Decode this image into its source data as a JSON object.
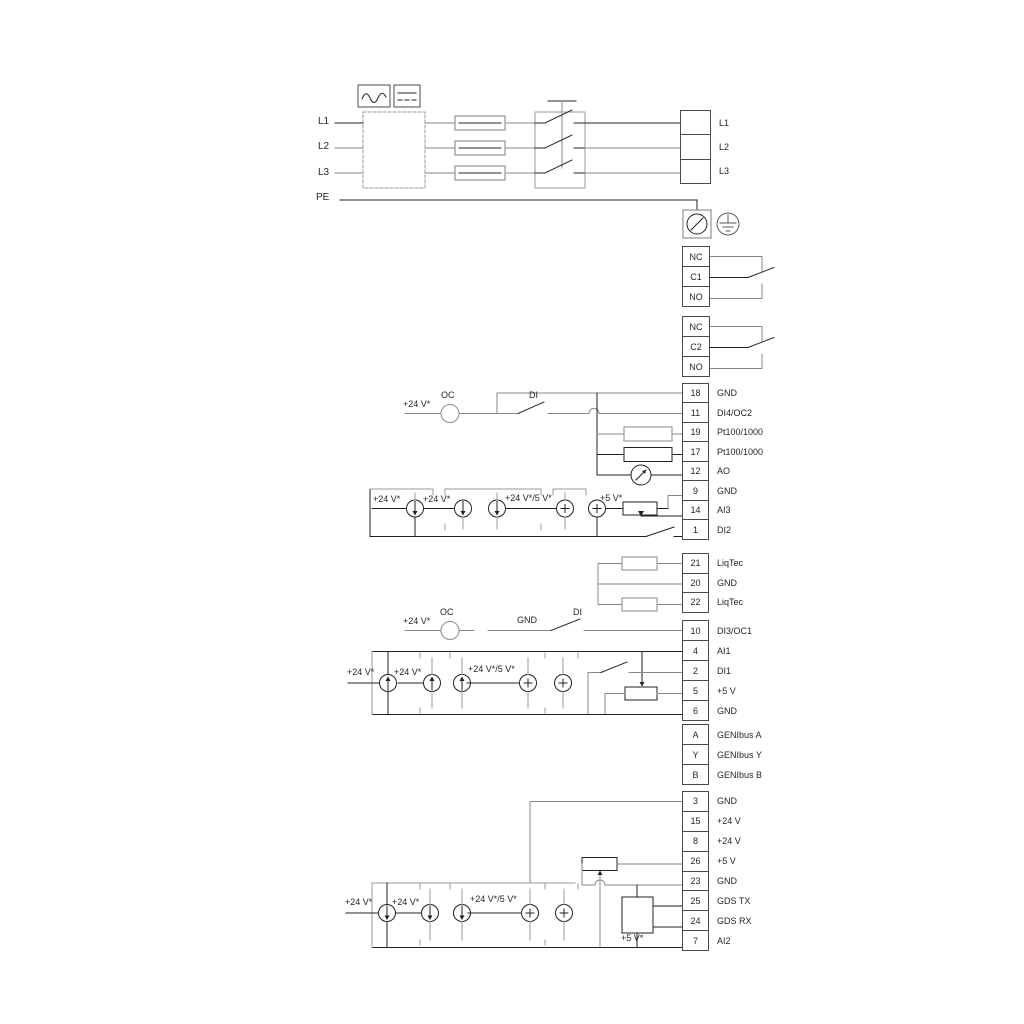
{
  "diagram": {
    "title": "drive terminal wiring diagram",
    "inputs": [
      "L1",
      "L2",
      "L3",
      "PE"
    ],
    "strips": {
      "power": [
        {
          "num": "",
          "label": "L1"
        },
        {
          "num": "",
          "label": "L2"
        },
        {
          "num": "",
          "label": "L3"
        }
      ],
      "relay1": [
        {
          "num": "NC",
          "label": ""
        },
        {
          "num": "C1",
          "label": ""
        },
        {
          "num": "NO",
          "label": ""
        }
      ],
      "relay2": [
        {
          "num": "NC",
          "label": ""
        },
        {
          "num": "C2",
          "label": ""
        },
        {
          "num": "NO",
          "label": ""
        }
      ],
      "io": [
        {
          "num": "18",
          "label": "GND"
        },
        {
          "num": "11",
          "label": "DI4/OC2"
        },
        {
          "num": "19",
          "label": "Pt100/1000"
        },
        {
          "num": "17",
          "label": "Pt100/1000"
        },
        {
          "num": "12",
          "label": "AO"
        },
        {
          "num": "9",
          "label": "GND"
        },
        {
          "num": "14",
          "label": "AI3"
        },
        {
          "num": "1",
          "label": "DI2"
        }
      ],
      "liqtec": [
        {
          "num": "21",
          "label": "LiqTec"
        },
        {
          "num": "20",
          "label": "GND"
        },
        {
          "num": "22",
          "label": "LiqTec"
        }
      ],
      "digital": [
        {
          "num": "10",
          "label": "DI3/OC1"
        },
        {
          "num": "4",
          "label": "AI1"
        },
        {
          "num": "2",
          "label": "DI1"
        },
        {
          "num": "5",
          "label": "+5 V"
        },
        {
          "num": "6",
          "label": "GND"
        }
      ],
      "genibus": [
        {
          "num": "A",
          "label": "GENIbus A"
        },
        {
          "num": "Y",
          "label": "GENIbus Y"
        },
        {
          "num": "B",
          "label": "GENIbus B"
        }
      ],
      "powerio": [
        {
          "num": "3",
          "label": "GND"
        },
        {
          "num": "15",
          "label": "+24 V"
        },
        {
          "num": "8",
          "label": "+24 V"
        },
        {
          "num": "26",
          "label": "+5 V"
        },
        {
          "num": "23",
          "label": "GND"
        },
        {
          "num": "25",
          "label": "GDS TX"
        },
        {
          "num": "24",
          "label": "GDS RX"
        },
        {
          "num": "7",
          "label": "AI2"
        }
      ]
    },
    "annotations": [
      {
        "text": "+24 V*"
      },
      {
        "text": "OC"
      },
      {
        "text": "DI"
      },
      {
        "text": "+24 V*"
      },
      {
        "text": "+24 V*"
      },
      {
        "text": "+24 V*/5 V*"
      },
      {
        "text": "+5 V*"
      },
      {
        "text": "+24 V*"
      },
      {
        "text": "OC"
      },
      {
        "text": "GND"
      },
      {
        "text": "DI"
      },
      {
        "text": "+24 V*"
      },
      {
        "text": "+24 V*"
      },
      {
        "text": "+24 V*/5 V*"
      },
      {
        "text": "+24 V*"
      },
      {
        "text": "+24 V*"
      },
      {
        "text": "+24 V*/5 V*"
      },
      {
        "text": "+5 V*"
      }
    ],
    "symbols": [
      "ac-sine-icon",
      "dc-icon",
      "rfi-filter-box",
      "fuse",
      "main-switch",
      "screw-terminal-icon",
      "earth-ground-icon",
      "relay-changeover-contact",
      "resistor",
      "analog-output-meter",
      "current-source",
      "voltage-source",
      "potentiometer",
      "open-collector",
      "digital-input-switch",
      "gds-sensor-box"
    ],
    "colors": {
      "background": "#ffffff",
      "wire_gray": "#8a8a8a",
      "wire_dark": "#222222",
      "text": "#262626"
    }
  }
}
